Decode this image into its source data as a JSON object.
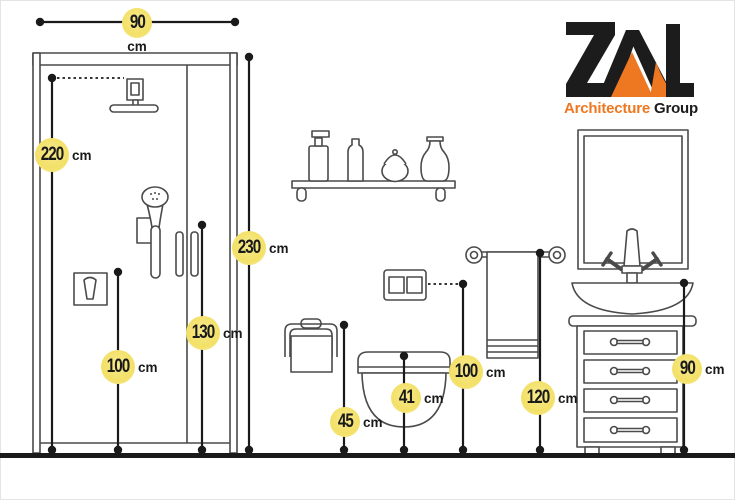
{
  "logo": {
    "mark": "ZAL",
    "line1": "Architecture",
    "line2": "Group"
  },
  "dimensions": [
    {
      "value": "90",
      "unit": "cm",
      "target": "shower-width"
    },
    {
      "value": "220",
      "unit": "cm",
      "target": "shower-head-height"
    },
    {
      "value": "230",
      "unit": "cm",
      "target": "shower-enclosure-height"
    },
    {
      "value": "130",
      "unit": "cm",
      "target": "hand-shower-height"
    },
    {
      "value": "100",
      "unit": "cm",
      "target": "shower-mixer-height"
    },
    {
      "value": "45",
      "unit": "cm",
      "target": "paper-holder-height"
    },
    {
      "value": "41",
      "unit": "cm",
      "target": "toilet-seat-height"
    },
    {
      "value": "100",
      "unit": "cm",
      "target": "flush-plate-height"
    },
    {
      "value": "120",
      "unit": "cm",
      "target": "towel-bar-height"
    },
    {
      "value": "90",
      "unit": "cm",
      "target": "vanity-height"
    }
  ],
  "colors": {
    "accent_orange": "#ee7722",
    "logo_black": "#1c1c1c",
    "label_yellow": "#f3e067",
    "line_black": "#1a1a1a",
    "fixture_gray": "#4a4a4a"
  }
}
